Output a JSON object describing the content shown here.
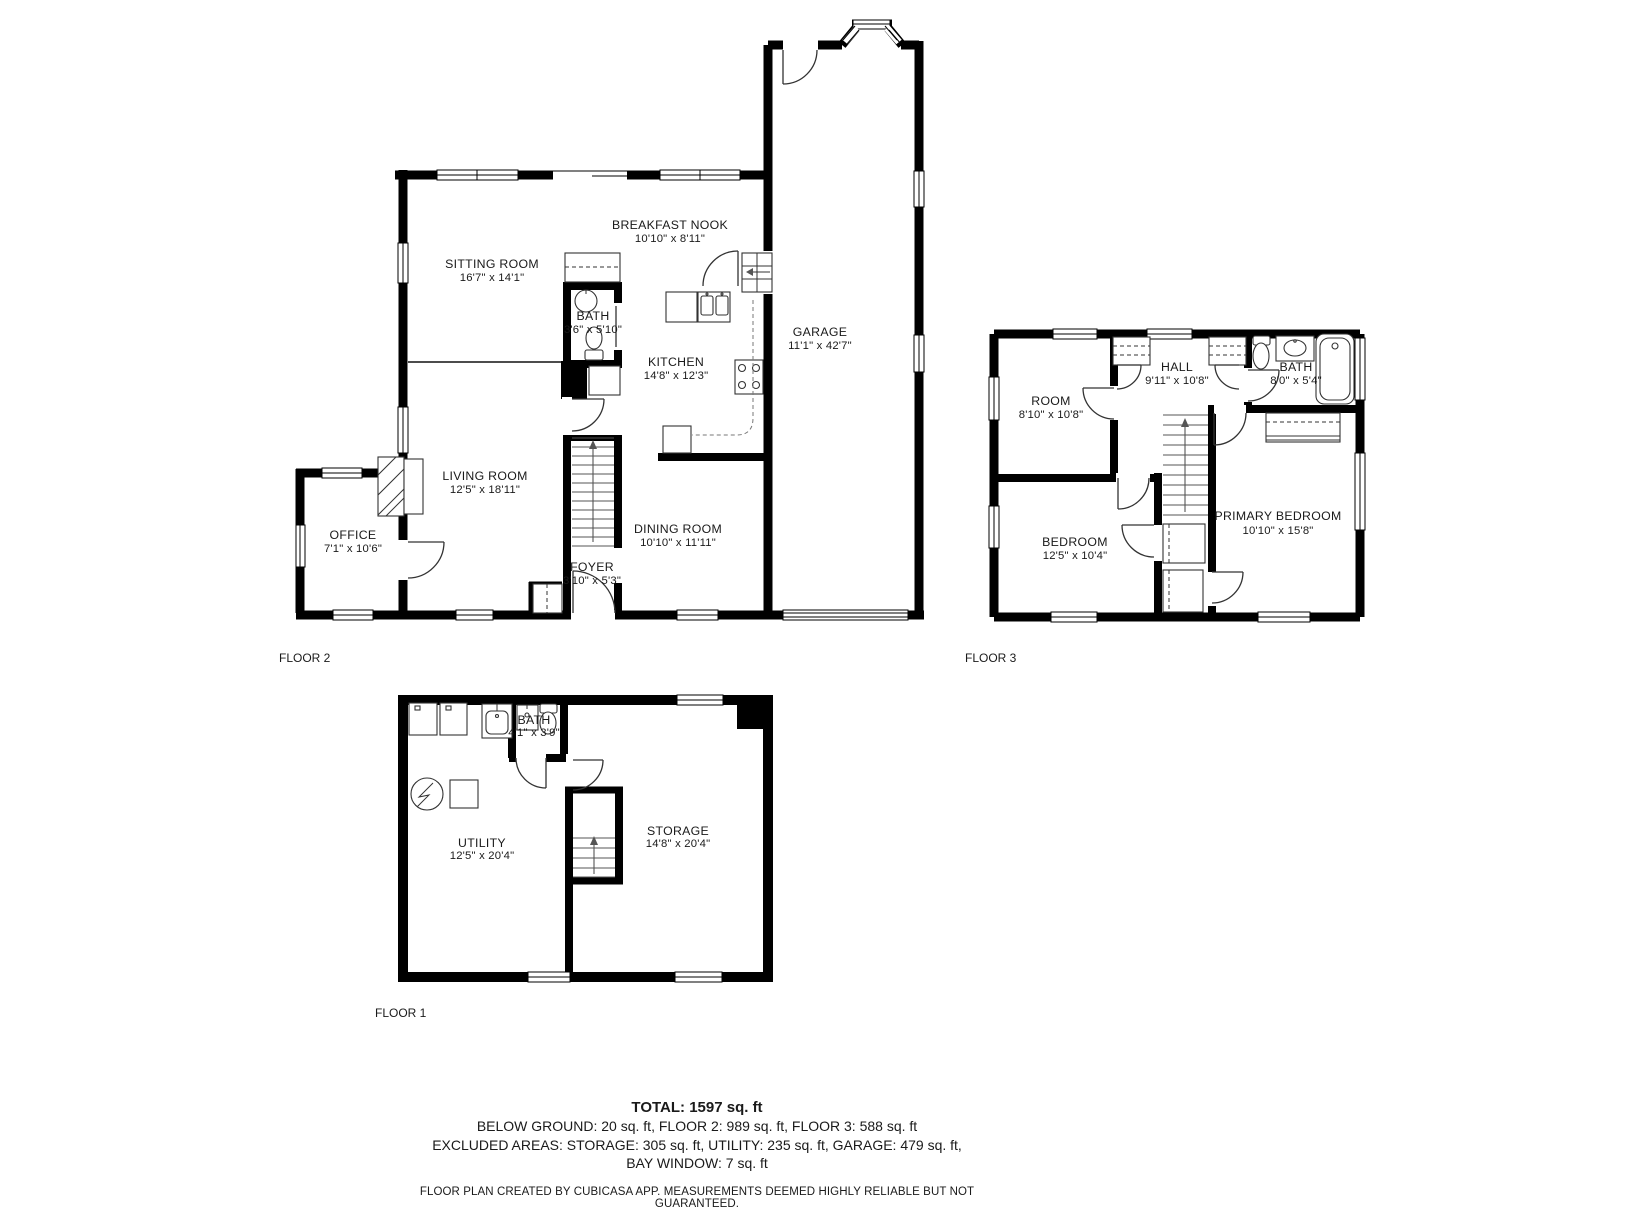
{
  "page": {
    "background": "#ffffff"
  },
  "colors": {
    "wall": "#000000",
    "text": "#1a1a1a",
    "fixture": "#333333"
  },
  "floors": [
    {
      "id": "floor2",
      "label": "FLOOR 2",
      "rooms": [
        {
          "key": "sitting-room",
          "name": "SITTING ROOM",
          "dims": "16'7\" x 14'1\""
        },
        {
          "key": "breakfast-nook",
          "name": "BREAKFAST NOOK",
          "dims": "10'10\" x 8'11\""
        },
        {
          "key": "bath",
          "name": "BATH",
          "dims": "3'6\" x 5'10\""
        },
        {
          "key": "kitchen",
          "name": "KITCHEN",
          "dims": "14'8\" x 12'3\""
        },
        {
          "key": "garage",
          "name": "GARAGE",
          "dims": "11'1\" x 42'7\""
        },
        {
          "key": "living-room",
          "name": "LIVING ROOM",
          "dims": "12'5\" x 18'11\""
        },
        {
          "key": "dining-room",
          "name": "DINING ROOM",
          "dims": "10'10\" x 11'11\""
        },
        {
          "key": "foyer",
          "name": "FOYER",
          "dims": "3'10\" x 5'3\""
        },
        {
          "key": "office",
          "name": "OFFICE",
          "dims": "7'1\" x 10'6\""
        }
      ]
    },
    {
      "id": "floor3",
      "label": "FLOOR 3",
      "rooms": [
        {
          "key": "room",
          "name": "ROOM",
          "dims": "8'10\" x 10'8\""
        },
        {
          "key": "hall",
          "name": "HALL",
          "dims": "9'11\" x 10'8\""
        },
        {
          "key": "bath",
          "name": "BATH",
          "dims": "8'0\" x 5'4\""
        },
        {
          "key": "bedroom",
          "name": "BEDROOM",
          "dims": "12'5\" x 10'4\""
        },
        {
          "key": "primary-bedroom",
          "name": "PRIMARY BEDROOM",
          "dims": "10'10\" x 15'8\""
        }
      ]
    },
    {
      "id": "floor1",
      "label": "FLOOR 1",
      "rooms": [
        {
          "key": "bath",
          "name": "BATH",
          "dims": "4'1\" x 3'9\""
        },
        {
          "key": "utility",
          "name": "UTILITY",
          "dims": "12'5\" x 20'4\""
        },
        {
          "key": "storage",
          "name": "STORAGE",
          "dims": "14'8\" x 20'4\""
        }
      ]
    }
  ],
  "summary": {
    "total": "TOTAL: 1597 sq. ft",
    "line2": "BELOW GROUND: 20 sq. ft, FLOOR 2: 989 sq. ft, FLOOR 3: 588 sq. ft",
    "line3": "EXCLUDED AREAS: STORAGE: 305 sq. ft, UTILITY: 235 sq. ft, GARAGE: 479 sq. ft,",
    "line4": "BAY WINDOW: 7 sq. ft"
  },
  "disclaimer": "FLOOR PLAN CREATED BY CUBICASA APP. MEASUREMENTS DEEMED HIGHLY RELIABLE BUT NOT GUARANTEED."
}
